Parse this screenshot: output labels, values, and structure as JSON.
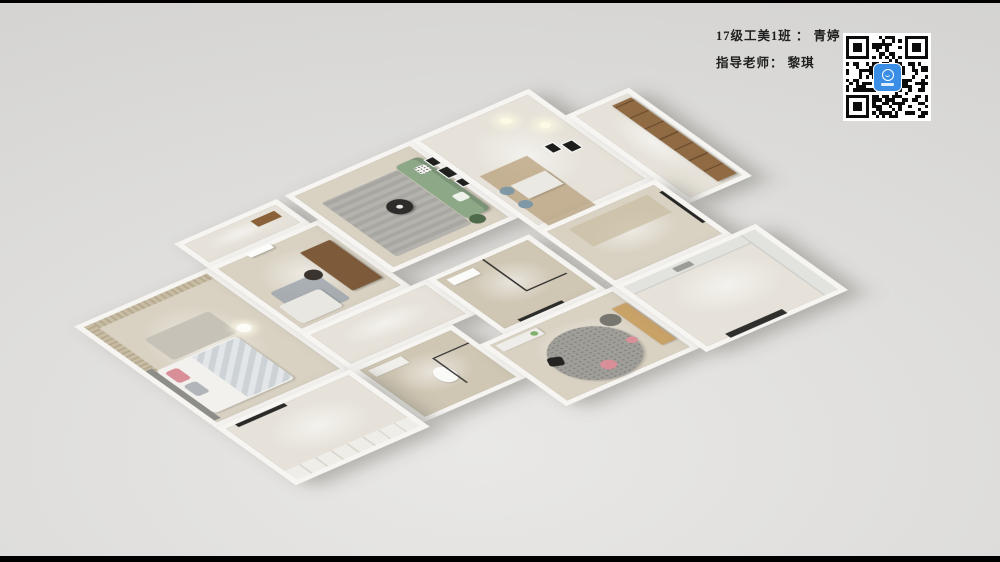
{
  "annotation": {
    "line1": "17级工美1班 ： 青婷",
    "line2": "指导老师： 黎琪"
  },
  "qr": {
    "icon_name": "qr-code-icon",
    "logo_icon_name": "kujiale-app-icon",
    "grid_size": 25
  },
  "colors": {
    "page_bg": "#dcdbd9",
    "page_bg_light": "#e9e8e6",
    "page_bg_dark": "#cfcecc",
    "letterbox": "#000000",
    "text": "#1f1f1f",
    "wall": "#f6f5f2",
    "qr_logo_blue": "#3a8ee6",
    "sofa_green": "#8da887",
    "desk_wood": "#7d5a3a",
    "cabinet_brown": "#8f6a43",
    "bench_wood": "#c9a268",
    "chair_blue": "#7f98a6",
    "curtain_beige": "#c8bda4",
    "floor_wood": "#d9d2c3",
    "floor_light": "#e6e2d9",
    "tile_beige": "#cfc6b3",
    "rug_gray": "#b4b3ae",
    "rug_round_gray": "#9f9e99",
    "pouf_pink": "#d98f98",
    "plant_green": "#4f6b4a",
    "headboard_gray": "#8d8d89"
  }
}
